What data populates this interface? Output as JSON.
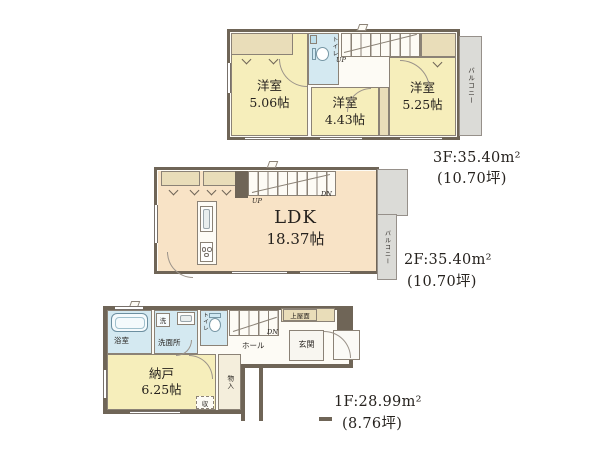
{
  "colors": {
    "wall": "#6f6557",
    "room_yellow": "#f6eebb",
    "room_peach": "#f8e3c6",
    "wet_room_blue": "#d4e9f1",
    "closet_tan": "#e9ddb9",
    "balcony_gray": "#dbdbd7"
  },
  "floor3": {
    "rooms": [
      {
        "name": "洋室",
        "size": "5.06帖"
      },
      {
        "name": "洋室",
        "size": "4.43帖"
      },
      {
        "name": "洋室",
        "size": "5.25帖"
      }
    ],
    "toilet": "トイレ",
    "stairs_up": "UP",
    "balcony": "バルコニー",
    "area": "3F:35.40m²",
    "tsubo": "(10.70坪)"
  },
  "floor2": {
    "ldk": {
      "name": "LDK",
      "size": "18.37帖"
    },
    "stairs_up": "UP",
    "stairs_down": "DN",
    "balcony": "バルコニー",
    "area": "2F:35.40m²",
    "tsubo": "(10.70坪)"
  },
  "floor1": {
    "bathroom": "浴室",
    "washer": "洗",
    "washroom": "洗面所",
    "toilet": "トイレ",
    "stairs_down": "DN",
    "canopy": "上屋面",
    "hall": "ホール",
    "entrance": "玄関",
    "storage": {
      "name": "納戸",
      "size": "6.25帖"
    },
    "closet": "物入",
    "cupboard": "収",
    "area": "1F:28.99m²",
    "tsubo": "(8.76坪)"
  }
}
